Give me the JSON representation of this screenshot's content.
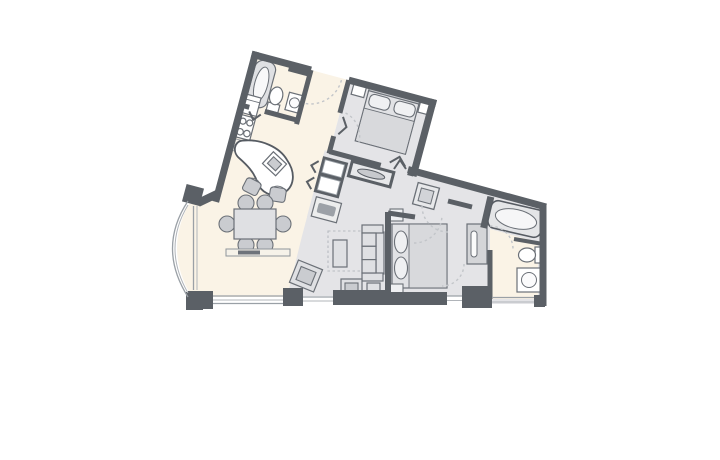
{
  "page": {
    "type": "architectural-floor-plan",
    "background": "#ffffff",
    "text_labels": []
  },
  "palette": {
    "wall": "#5b6066",
    "cream": "#faf3e6",
    "floor": "#e4e4e7",
    "furn": "#dfe0e3",
    "furnd": "#caccd0",
    "white": "#ffffff",
    "stroke": "#6b7077",
    "dash": "#c2c5c9",
    "win": "#9aa0a6",
    "pad": "#9ca1a7"
  },
  "plan": {
    "rooms": [
      "bathroom-1",
      "kitchen",
      "entry-hall",
      "bedroom-2",
      "dining-area",
      "living-room",
      "master-bedroom",
      "bathroom-2",
      "balcony"
    ],
    "fixtures": [
      "bathtub",
      "toilet",
      "sink-vanity",
      "refrigerator",
      "stove",
      "curved-desk",
      "dining-table",
      "sofa",
      "coffee-table",
      "bed",
      "nightstand",
      "dresser-tv",
      "wet-bar",
      "bench",
      "door-swing-arcs",
      "windows"
    ]
  }
}
